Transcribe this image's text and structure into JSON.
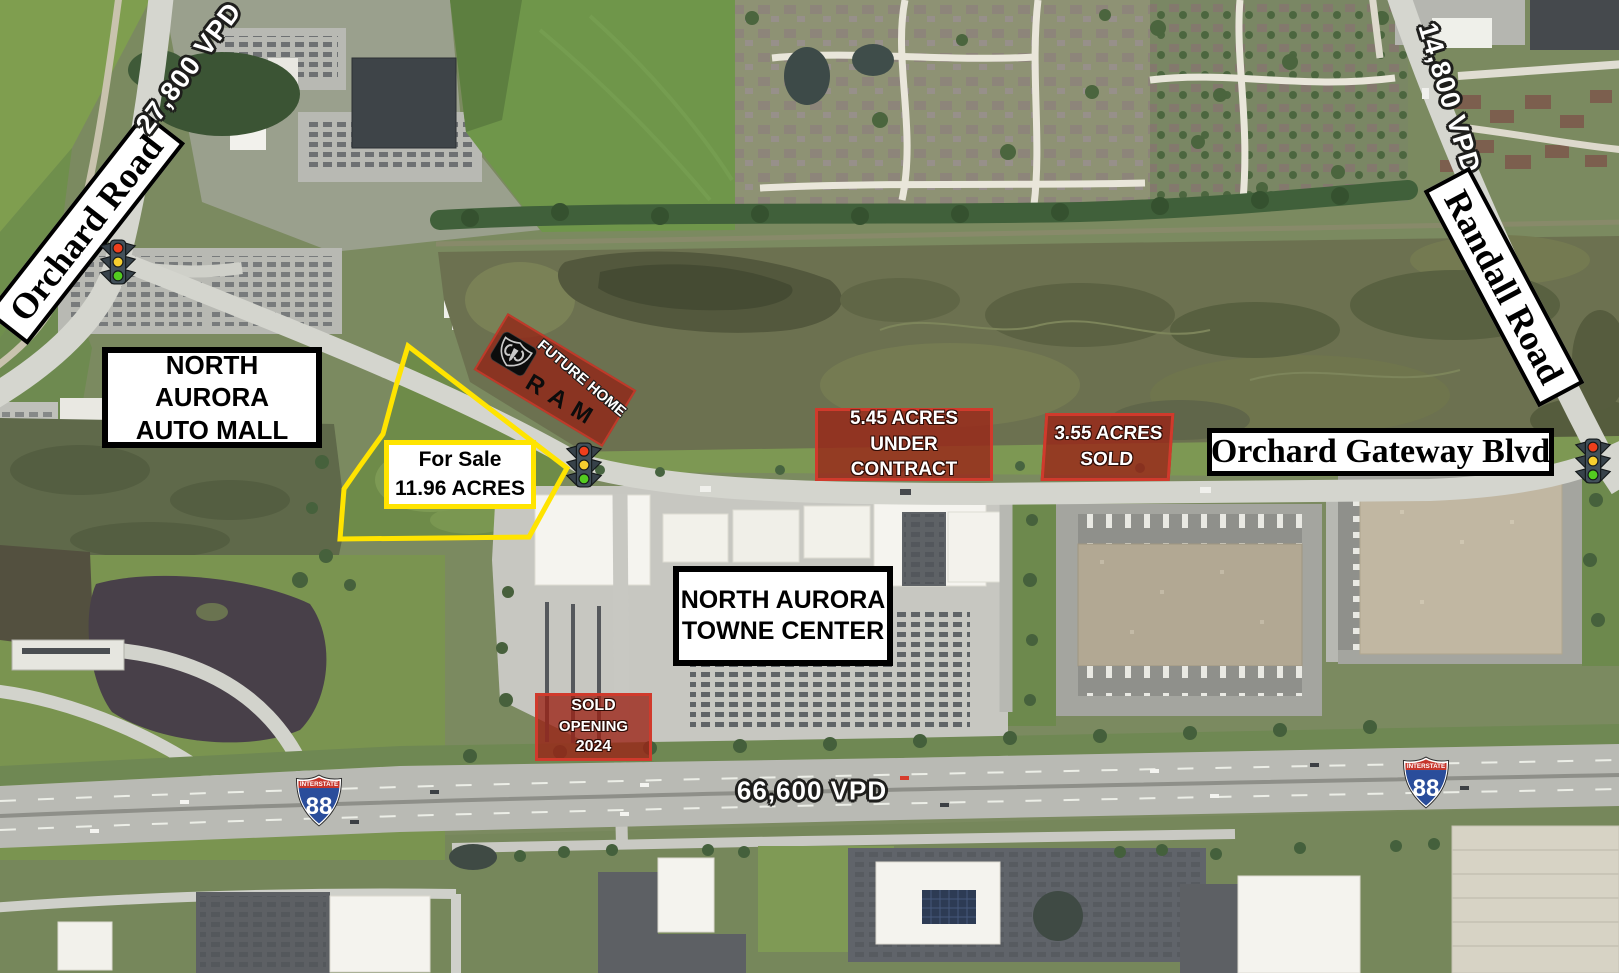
{
  "map_title": "North Aurora IL commercial land aerial map",
  "roads": {
    "orchard_road": {
      "label": "Orchard Road",
      "vpd": "27,800 VPD"
    },
    "randall_road": {
      "label": "Randall Road",
      "vpd": "14,800 VPD"
    },
    "orchard_gateway_blvd": {
      "label": "Orchard Gateway Blvd"
    },
    "interstate_88": {
      "shield_top": "INTERSTATE",
      "shield_number": "88",
      "vpd": "66,600 VPD"
    }
  },
  "places": {
    "auto_mall": {
      "line1": "NORTH AURORA",
      "line2": "AUTO MALL"
    },
    "towne_center": {
      "line1": "NORTH AURORA",
      "line2": "TOWNE CENTER"
    }
  },
  "parcels": {
    "for_sale": {
      "line1": "For Sale",
      "line2": "11.96 ACRES"
    },
    "under_contract": {
      "line1": "5.45 ACRES",
      "line2": "UNDER CONTRACT"
    },
    "sold_east": {
      "line1": "3.55 ACRES",
      "line2": "SOLD"
    },
    "sold_outlot": {
      "line1": "SOLD",
      "line2": "OPENING",
      "line3": "2024"
    },
    "ram_site": {
      "line1": "FUTURE HOME",
      "brand": "RAM"
    }
  },
  "icons": {
    "traffic_light": "traffic-light-icon",
    "interstate_shield": "interstate-88-shield-icon",
    "ram_badge": "ram-logo-icon"
  },
  "colors": {
    "highlight_yellow": "#ffe400",
    "parcel_red_fill": "rgba(155,35,22,0.78)",
    "parcel_red_border": "#d03a2c",
    "label_border_black": "#000000",
    "shield_red": "#c6352c",
    "shield_blue": "#2a4d9b"
  }
}
